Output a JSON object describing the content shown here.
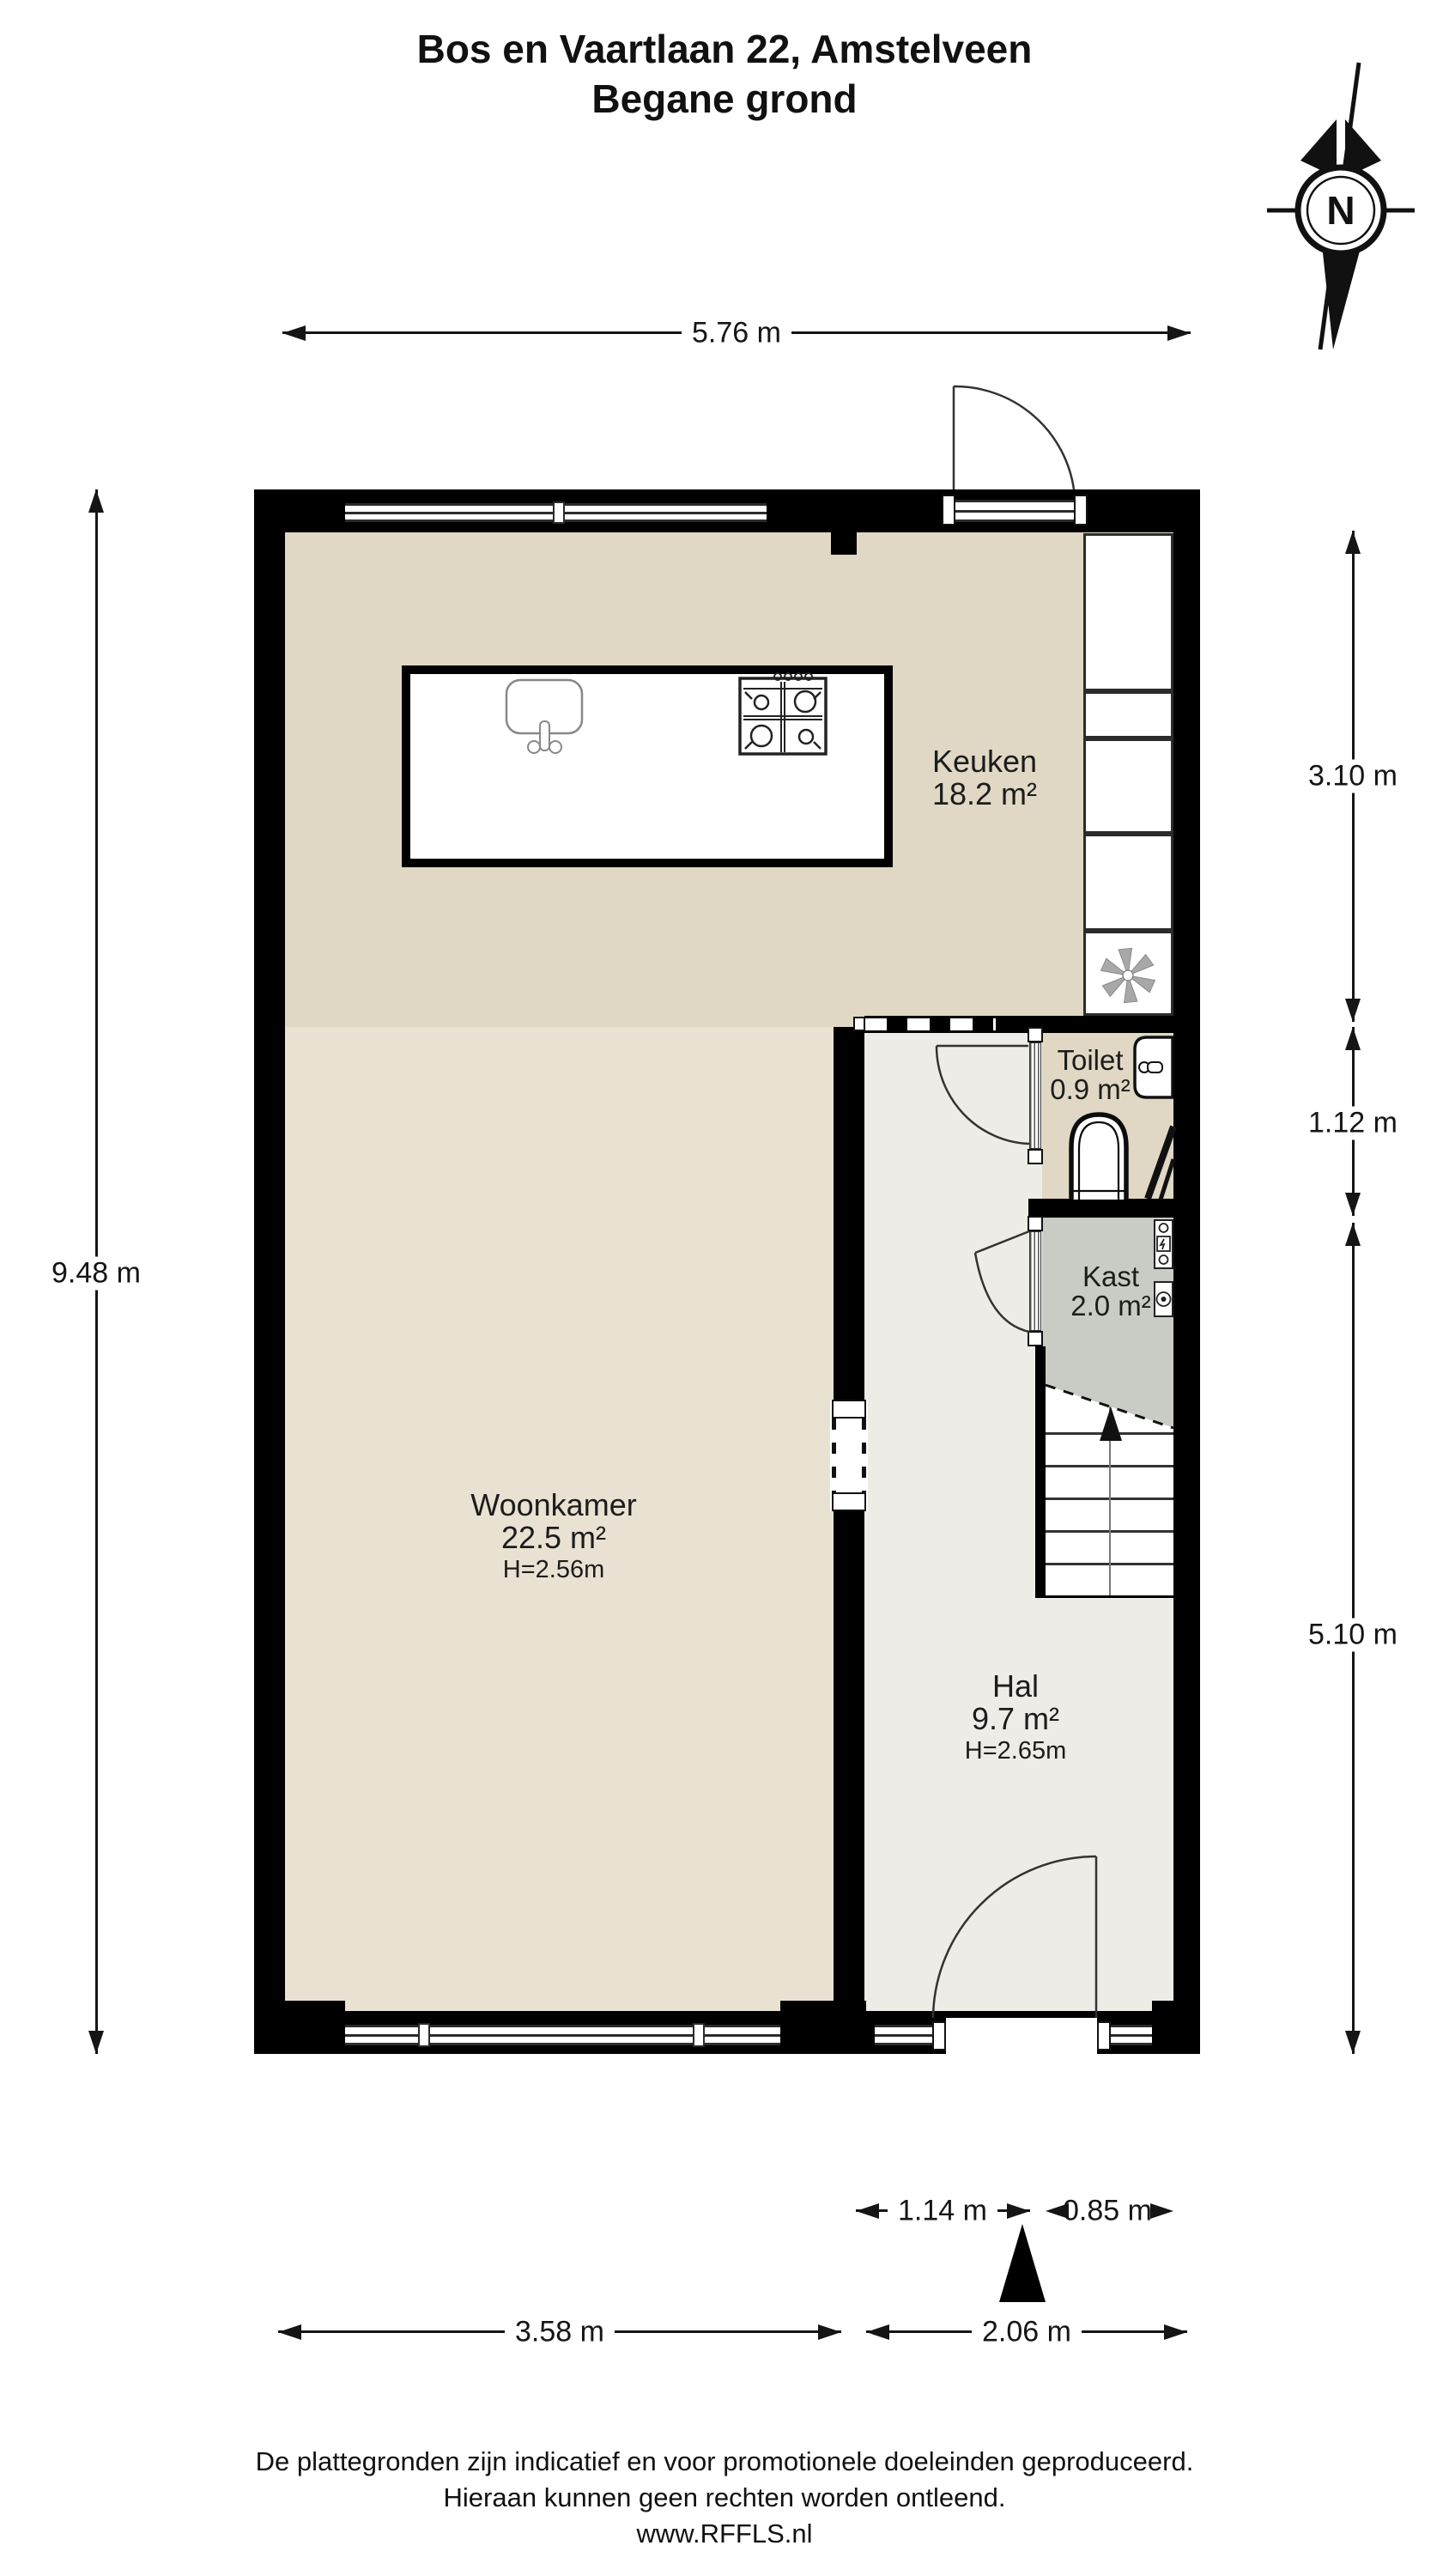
{
  "title": {
    "line1": "Bos en Vaartlaan 22, Amstelveen",
    "line2": "Begane grond"
  },
  "compass": {
    "label": "N"
  },
  "rooms": {
    "keuken": {
      "name": "Keuken",
      "area": "18.2 m²"
    },
    "woonkamer": {
      "name": "Woonkamer",
      "area": "22.5 m²",
      "ceiling": "H=2.56m"
    },
    "hal": {
      "name": "Hal",
      "area": "9.7 m²",
      "ceiling": "H=2.65m"
    },
    "toilet": {
      "name": "Toilet",
      "area": "0.9 m²"
    },
    "kast": {
      "name": "Kast",
      "area": "2.0 m²"
    }
  },
  "dimensions": {
    "top_width": "5.76 m",
    "left_height": "9.48 m",
    "right_keuken": "3.10 m",
    "right_toilet": "1.12 m",
    "right_hal": "5.10 m",
    "bottom_hal_corridor": "1.14 m",
    "bottom_kast": "0.85 m",
    "bottom_woonkamer": "3.58 m",
    "bottom_hal": "2.06 m"
  },
  "footer": {
    "line1": "De plattegronden zijn indicatief en voor promotionele doeleinden geproduceerd.",
    "line2": "Hieraan kunnen geen rechten worden ontleend.",
    "line3": "www.RFFLS.nl"
  },
  "colors": {
    "wall": "#000000",
    "keuken_floor": "#e0d8c4",
    "woonkamer_floor": "#e9e1d2",
    "hal_floor": "#edece6",
    "kast_floor": "#c9ccc4",
    "fan_symbol": "#a8a8a8"
  }
}
